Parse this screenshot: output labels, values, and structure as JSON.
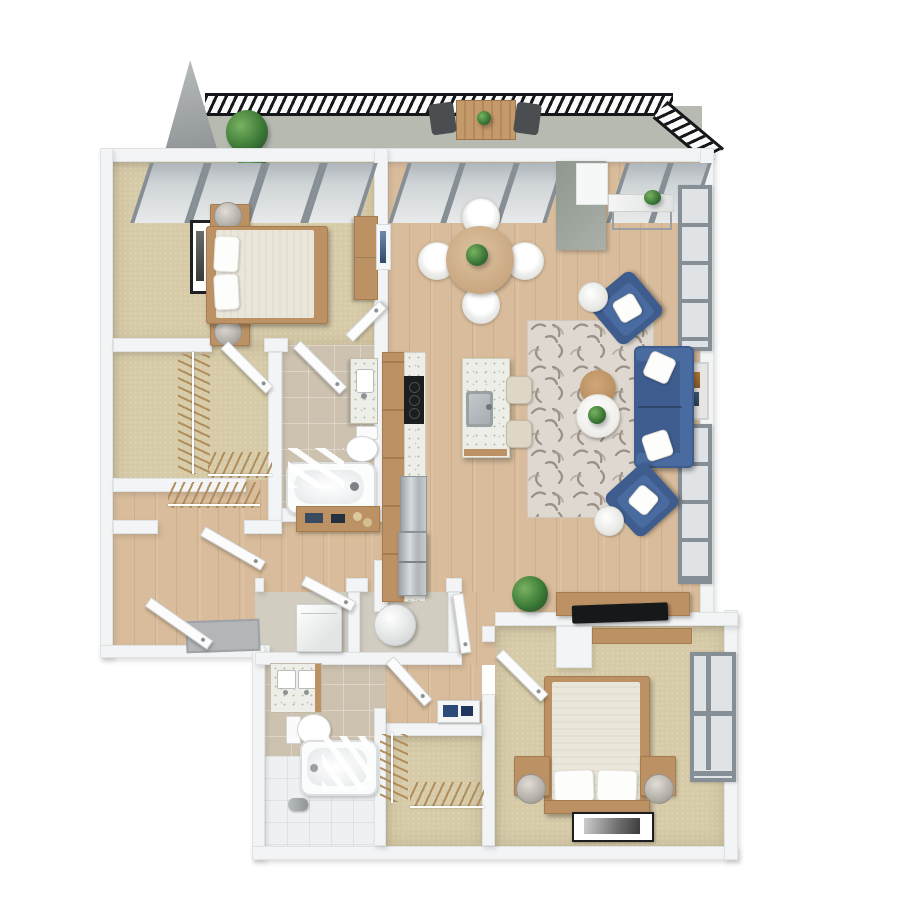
{
  "scene": {
    "type": "3d-floor-plan-render",
    "view": "top-down",
    "unit": "two-bedroom apartment with balcony",
    "visible_text": "none"
  },
  "palette": {
    "bg": "#ffffff",
    "wall": "#f3f4f5",
    "wallEdge": "#e0e3e4",
    "woodFloor": "#d8bc9b",
    "carpet": "#d6caa7",
    "tile": "#cdc2b0",
    "showerTile": "#eef0f2",
    "balconyFloor": "#b7bab1",
    "railing": "#16171b",
    "glass": "#dfe3e5",
    "glassFrame": "#878f96",
    "blue": "#3e5c8d",
    "blueLight": "#4a6ba0",
    "woodFurn": "#bc9164",
    "woodFurnDark": "#a57c50",
    "linen": "#eae6d9",
    "rugBase": "#ded8d0",
    "rugMark": "#8a7e72",
    "concrete": "#99a09b",
    "applianceBlack": "#1c1d1e"
  },
  "rooms": [
    {
      "id": "balcony",
      "floor": "concrete",
      "furniture": [
        "outdoor-table",
        "outdoor-chair",
        "outdoor-chair",
        "potted-plant",
        "table-plant"
      ]
    },
    {
      "id": "master-bedroom",
      "floor": "carpet",
      "furniture": [
        "double-bed",
        "nightstand",
        "nightstand",
        "table-lamp",
        "table-lamp",
        "wall-art",
        "dresser"
      ]
    },
    {
      "id": "walk-in-closet",
      "floor": "carpet",
      "furniture": [
        "hanging-rail-with-hangers",
        "hanging-rail-with-hangers",
        "hanging-rail-with-hangers"
      ]
    },
    {
      "id": "bathroom-1",
      "floor": "tile",
      "furniture": [
        "vanity-sink",
        "toilet",
        "bathtub",
        "shower-screen"
      ]
    },
    {
      "id": "hallway",
      "floor": "hardwood",
      "furniture": [
        "console-dresser",
        "entry-door-mat"
      ]
    },
    {
      "id": "kitchen",
      "floor": "hardwood",
      "furniture": [
        "counter-run",
        "cooktop",
        "refrigerator",
        "island-with-sink",
        "bar-stool",
        "bar-stool"
      ]
    },
    {
      "id": "dining-area",
      "floor": "hardwood",
      "furniture": [
        "round-dining-table",
        "dining-chair",
        "dining-chair",
        "dining-chair",
        "dining-chair",
        "centerpiece-plant"
      ]
    },
    {
      "id": "living-room",
      "floor": "hardwood",
      "furniture": [
        "sofa",
        "armchair",
        "armchair",
        "area-rug",
        "coffee-table-wood",
        "coffee-table-white",
        "side-table",
        "side-table",
        "console-table",
        "media-console",
        "tv",
        "floor-plant",
        "wall-art",
        "structural-column"
      ]
    },
    {
      "id": "laundry-closet",
      "floor": "tile",
      "furniture": [
        "washer",
        "dryer"
      ]
    },
    {
      "id": "bathroom-2",
      "floor": "tile",
      "furniture": [
        "double-vanity",
        "toilet",
        "bathtub",
        "shower-area",
        "towel-fixture"
      ]
    },
    {
      "id": "closet-2",
      "floor": "carpet",
      "furniture": [
        "hanging-rail-with-hangers",
        "hanging-rail-with-hangers",
        "framed-art-on-floor"
      ]
    },
    {
      "id": "bedroom-2",
      "floor": "carpet",
      "furniture": [
        "double-bed",
        "nightstand",
        "nightstand",
        "table-lamp",
        "table-lamp",
        "framed-art-on-floor",
        "window"
      ]
    }
  ],
  "counts": {
    "bedrooms": 2,
    "bathrooms": 2,
    "dining_chairs": 4,
    "bar_stools": 2,
    "armchairs": 2,
    "balcony_chairs": 2,
    "doors": 9
  }
}
